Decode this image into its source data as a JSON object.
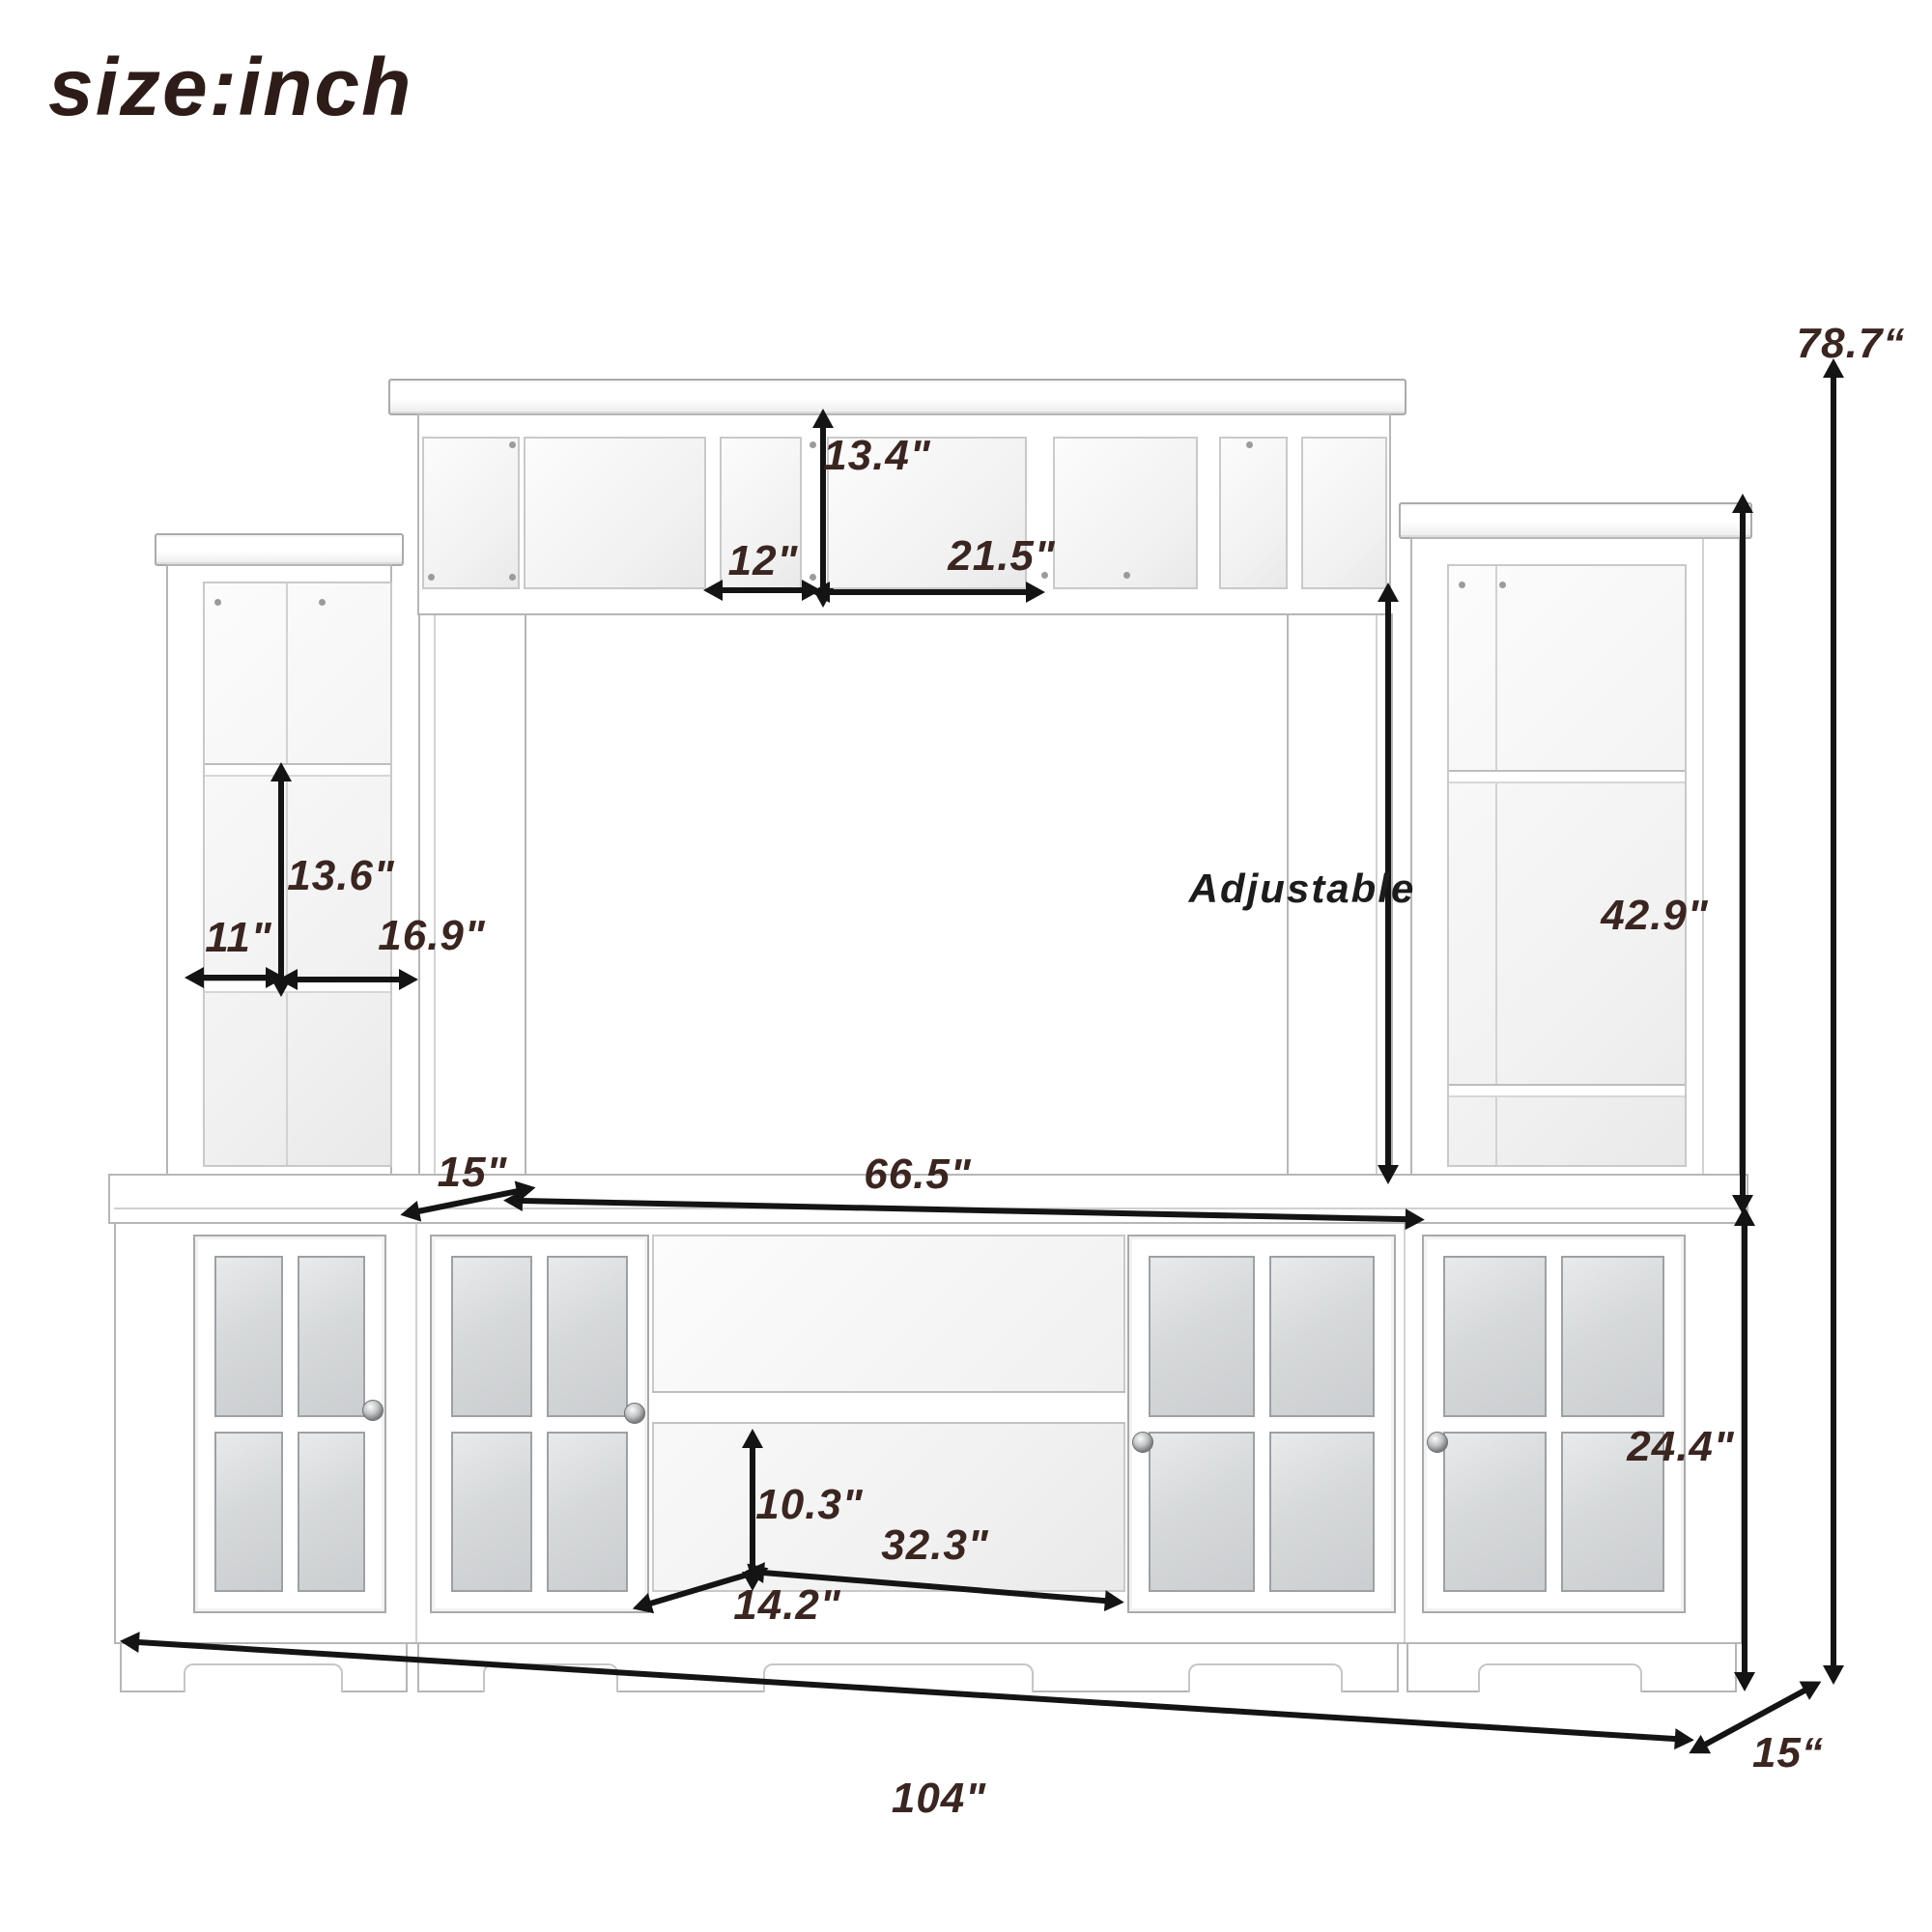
{
  "title": "size:inch",
  "colors": {
    "background": "#ffffff",
    "outline": "#b6b6b6",
    "glass": "#d6d9da",
    "arrow": "#141414",
    "label": "#3a2520",
    "title": "#2d1c17"
  },
  "annotation": {
    "adjustable": "Adjustable"
  },
  "dimensions": {
    "hutch_height": {
      "value": "13.4\""
    },
    "hutch_left": {
      "value": "12\""
    },
    "hutch_right": {
      "value": "21.5\""
    },
    "tower_shelf": {
      "value": "13.6\""
    },
    "tower_depth": {
      "value": "11\""
    },
    "tower_width": {
      "value": "16.9\""
    },
    "right_tower": {
      "value": "42.9\""
    },
    "total_height": {
      "value": "78.7“"
    },
    "pier_depth": {
      "value": "15\""
    },
    "console_width": {
      "value": "66.5\""
    },
    "shelf_clearance": {
      "value": "10.3\""
    },
    "shelf_width": {
      "value": "32.3\""
    },
    "console_depth": {
      "value": "14.2\""
    },
    "base_height": {
      "value": "24.4\""
    },
    "total_width": {
      "value": "104\""
    },
    "base_depth": {
      "value": "15“"
    }
  }
}
